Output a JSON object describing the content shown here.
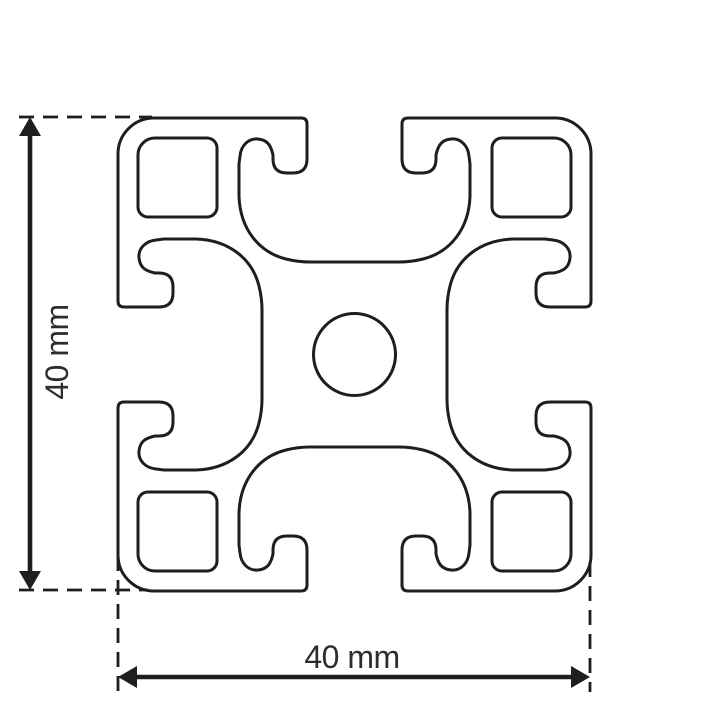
{
  "colors": {
    "line": "#1e1e1e",
    "text": "#2d2d2d",
    "background": "#ffffff"
  },
  "drawing": {
    "dimensions": {
      "height": {
        "label": "40 mm"
      },
      "width": {
        "label": "40 mm"
      }
    }
  }
}
